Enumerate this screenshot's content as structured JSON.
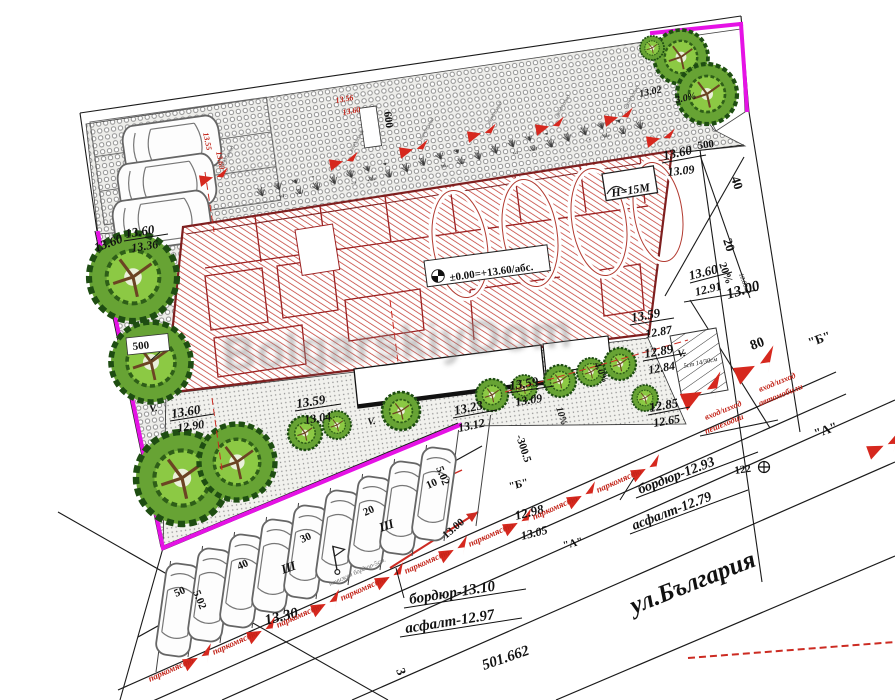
{
  "watermark": {
    "text": "BolgarskiyDom"
  },
  "colors": {
    "boundary": "#e512e5",
    "building_hatch": "#c23b32",
    "marker_red": "#d6281e",
    "tree": "#67a334"
  },
  "labels": {
    "tl_italic": "13.60",
    "tl_top": "13.60",
    "tl_bot": "13.36",
    "sw_top": "13.60",
    "sw_bot": "12.90",
    "mid_top": "13.59",
    "mid_bot": "13.04",
    "mide_top": "13.59",
    "mide_bot": "13.09",
    "k1323": "13.23",
    "k1312": "13.12",
    "ne_top": "13.60",
    "ne_bot": "13.09",
    "k1302": "13.02",
    "slope3": "3.0%",
    "se_top": "13.59",
    "se_bot": "12.87",
    "ramp_top": "13.60",
    "ramp_bot": "12.91",
    "k1300_ramp": "13.00",
    "k1289": "12.89",
    "k1284": "12.84",
    "k1285": "12.85",
    "k1265": "12.65",
    "k1298": "12.98",
    "k1305": "13.05",
    "k1330": "13.30",
    "k1300_arrow": "13.00",
    "slope4": "4.0%",
    "slope10": "10%",
    "slope20": "20%",
    "len1080": "10.80м.",
    "d500l": "500",
    "d600": "600",
    "d500r": "500",
    "d40": "40",
    "d20": "20",
    "d80": "80",
    "d3005": "-300.5",
    "d502a": "5.02",
    "d502b": "5.02",
    "chain50": "50",
    "chain40": "40",
    "chain30": "30",
    "chain20": "20",
    "chain10": "10",
    "curb_b": "бордюр-12.93",
    "asph_b": "асфалт-12.79",
    "curb_a": "бордюр-13.10",
    "asph_a": "асфалт-12.97",
    "area": "501.662",
    "street_name": "ул.България",
    "qb1": "\"Б\"",
    "qa1": "\"А\"",
    "qb2": "\"Б\"",
    "qa2": "\"А\"",
    "bench": "122",
    "plot3": "3",
    "sh": "Ш",
    "v": "V.",
    "stairs": "5ст 14/30см",
    "h15": "Н=15М",
    "zero": "±0.00=+13.60/абс.",
    "red_tl_a": "13.55",
    "red_tl_b": "13.60",
    "red_tc_a": "13.56",
    "red_tc_b": "13.60",
    "parking_spot": "паркомясто",
    "lowered_curb": "понижен бордюр-5см.",
    "entr": "вход/изход",
    "ped": "пешеходци",
    "cars": "автомобили"
  }
}
